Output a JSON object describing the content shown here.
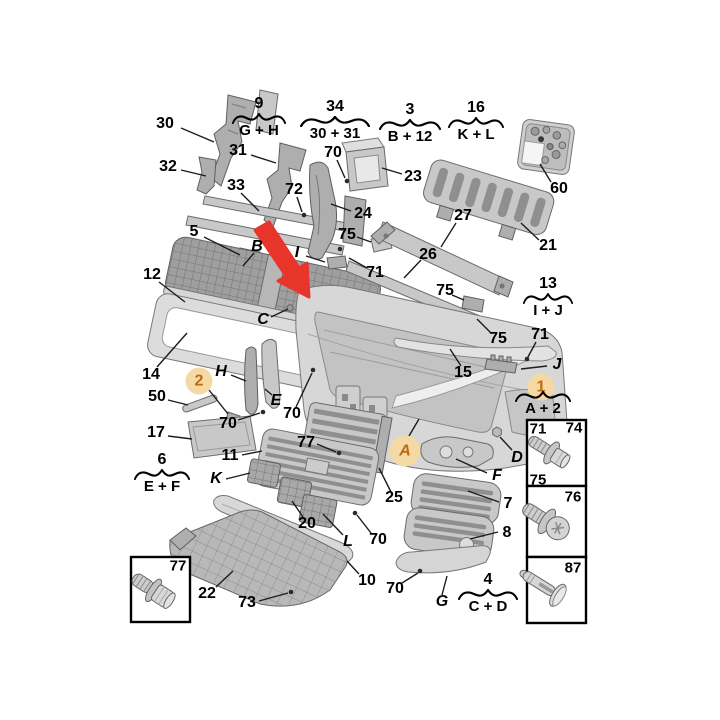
{
  "colors": {
    "arrow": "#e8352b",
    "highlight_bg": "#f4d9a5",
    "highlight_text": "#bd6b0d",
    "leader_line": "#1c1c1c"
  },
  "callouts": {
    "n2": "2",
    "n3": "3",
    "n4": "4",
    "n5": "5",
    "n6": "6",
    "n7": "7",
    "n8": "8",
    "n9": "9",
    "n10": "10",
    "n11": "11",
    "n12": "12",
    "n13": "13",
    "n14": "14",
    "n15": "15",
    "n16": "16",
    "n17": "17",
    "n20": "20",
    "n21": "21",
    "n22": "22",
    "n23": "23",
    "n24": "24",
    "n25": "25",
    "n26": "26",
    "n27": "27",
    "n30": "30",
    "n31": "31",
    "n32": "32",
    "n33": "33",
    "n34": "34",
    "n50": "50",
    "n60": "60",
    "n70": "70",
    "n71": "71",
    "n72": "72",
    "n73": "73",
    "n74": "74",
    "n75": "75",
    "n76": "76",
    "n77": "77",
    "n87": "87",
    "A": "A",
    "B": "B",
    "C": "C",
    "D": "D",
    "E": "E",
    "F": "F",
    "G": "G",
    "H": "H",
    "I": "I",
    "J": "J",
    "K": "K",
    "L": "L"
  },
  "assemblies": {
    "g9": {
      "number": "9",
      "components": "G + H"
    },
    "g34": {
      "number": "34",
      "components": "30 + 31"
    },
    "g3": {
      "number": "3",
      "components": "B + 12"
    },
    "g16": {
      "number": "16",
      "components": "K + L"
    },
    "g13": {
      "number": "13",
      "components": "I + J"
    },
    "g1": {
      "number": "1",
      "components": "A + 2"
    },
    "g6": {
      "number": "6",
      "components": "E + F"
    },
    "g4": {
      "number": "4",
      "components": "C + D"
    }
  }
}
